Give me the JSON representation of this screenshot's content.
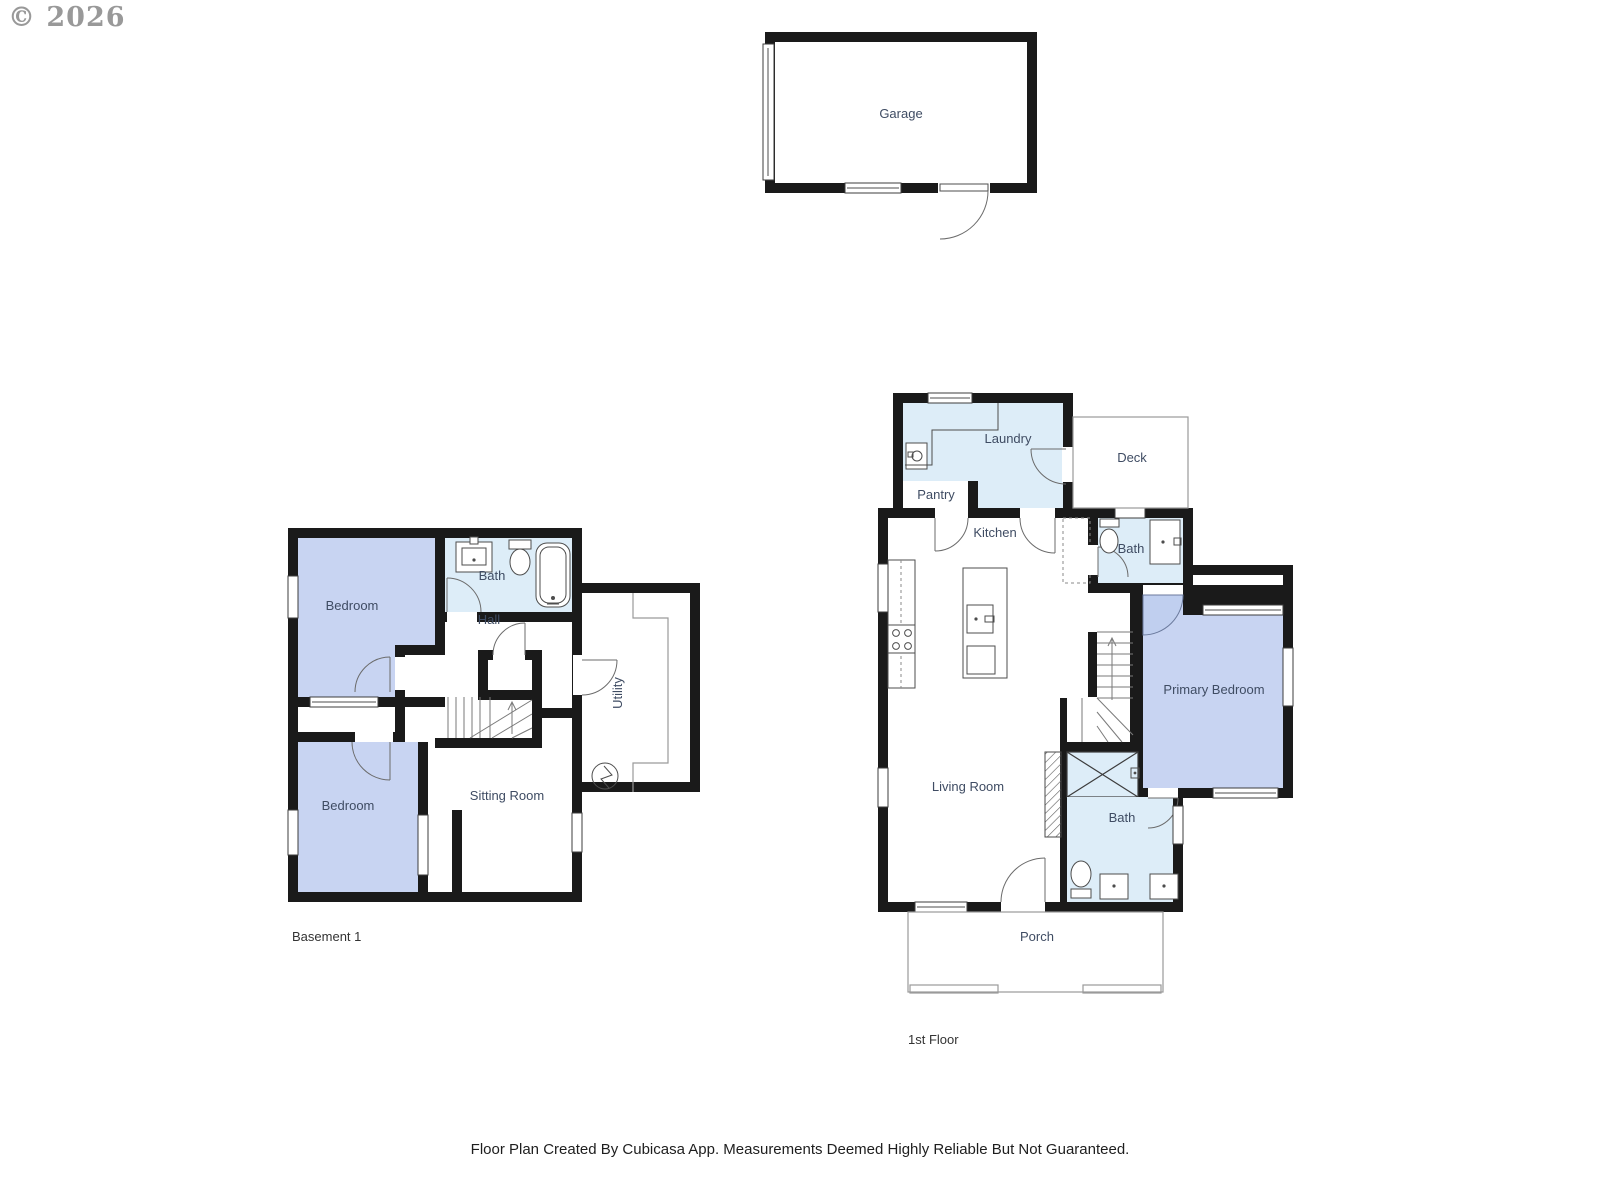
{
  "watermark": "© 2026",
  "footer": "Floor Plan Created By Cubicasa App. Measurements Deemed Highly Reliable But Not Guaranteed.",
  "colors": {
    "wall": "#1a1a1a",
    "bedroom_fill": "#c8d4f2",
    "wet_room_fill": "#ddedf8",
    "room_label": "#3f4c63",
    "thin_outline": "#9a9a9a"
  },
  "floors": {
    "garage": {
      "rooms": {
        "garage": "Garage"
      }
    },
    "basement": {
      "caption": "Basement 1",
      "rooms": {
        "bedroom_upper": "Bedroom",
        "bath": "Bath",
        "hall": "Hall",
        "utility": "Utility",
        "bedroom_lower": "Bedroom",
        "sitting_room": "Sitting Room"
      }
    },
    "first_floor": {
      "caption": "1st Floor",
      "rooms": {
        "laundry": "Laundry",
        "deck": "Deck",
        "pantry": "Pantry",
        "kitchen": "Kitchen",
        "bath_upper": "Bath",
        "primary_bedroom": "Primary Bedroom",
        "living_room": "Living Room",
        "bath_lower": "Bath",
        "porch": "Porch"
      }
    }
  }
}
